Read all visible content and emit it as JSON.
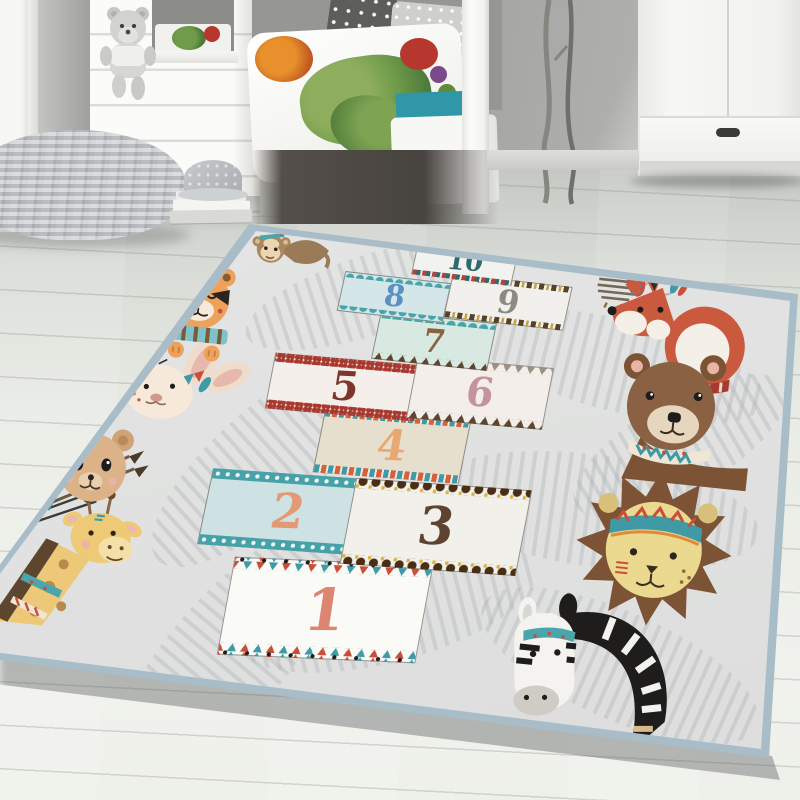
{
  "scene_title": "Kids room with hopscotch play rug",
  "rug": {
    "base_color": "#e3e4e3",
    "leaf_color": "#d3d4d5",
    "binding_color": "#a9bdc9",
    "squares": [
      {
        "number": "1",
        "bg": "#fafaf7",
        "number_color": "#dd8570",
        "border_style": "teal-red-triangles-black-dots"
      },
      {
        "number": "2",
        "bg": "#cfe2e3",
        "number_color": "#e29a74",
        "border_style": "teal-band-white-dots"
      },
      {
        "number": "3",
        "bg": "#f1f0ea",
        "number_color": "#5f4330",
        "border_style": "brown-blobs-yellow-dots"
      },
      {
        "number": "4",
        "bg": "#e7dfcd",
        "number_color": "#e7a872",
        "border_style": "teal-red-chevrons"
      },
      {
        "number": "5",
        "bg": "#f5efec",
        "number_color": "#7e352b",
        "border_style": "red-diamond-dots"
      },
      {
        "number": "6",
        "bg": "#f4eeeb",
        "number_color": "#c3949c",
        "border_style": "gray-top-brown-bottom-zigzag"
      },
      {
        "number": "7",
        "bg": "#d8e9e2",
        "number_color": "#8a6242",
        "border_style": "teal-scallop-brown-zigzag"
      },
      {
        "number": "8",
        "bg": "#d5e6e9",
        "number_color": "#5c8fc4",
        "border_style": "teal-scallop"
      },
      {
        "number": "9",
        "bg": "#f1f0ec",
        "number_color": "#8b8b83",
        "border_style": "brown-yellow-dashes"
      },
      {
        "number": "10",
        "bg": "#f2f3f1",
        "number_color": "#2f6a6e",
        "border_style": "red-teal-dashes"
      }
    ],
    "animals": [
      "monkey",
      "owl",
      "fox",
      "bear",
      "lion",
      "zebra",
      "giraffe",
      "teddy-bear",
      "rabbit",
      "tiger"
    ]
  },
  "room": {
    "wall_color": "#9c9c9a",
    "floor_color": "#e9ece6",
    "furniture_color": "#f5f5f3",
    "pouf_color": "#c6c9cb",
    "mattress_color": "#2f97a8",
    "objects": [
      "window-frame",
      "house-bed-panel",
      "teddy-bear-plush",
      "caterpillar-pillow",
      "bed",
      "polka-dot-pillows",
      "duvet",
      "pouf",
      "book-stack",
      "cap",
      "branches",
      "wardrobe"
    ]
  }
}
